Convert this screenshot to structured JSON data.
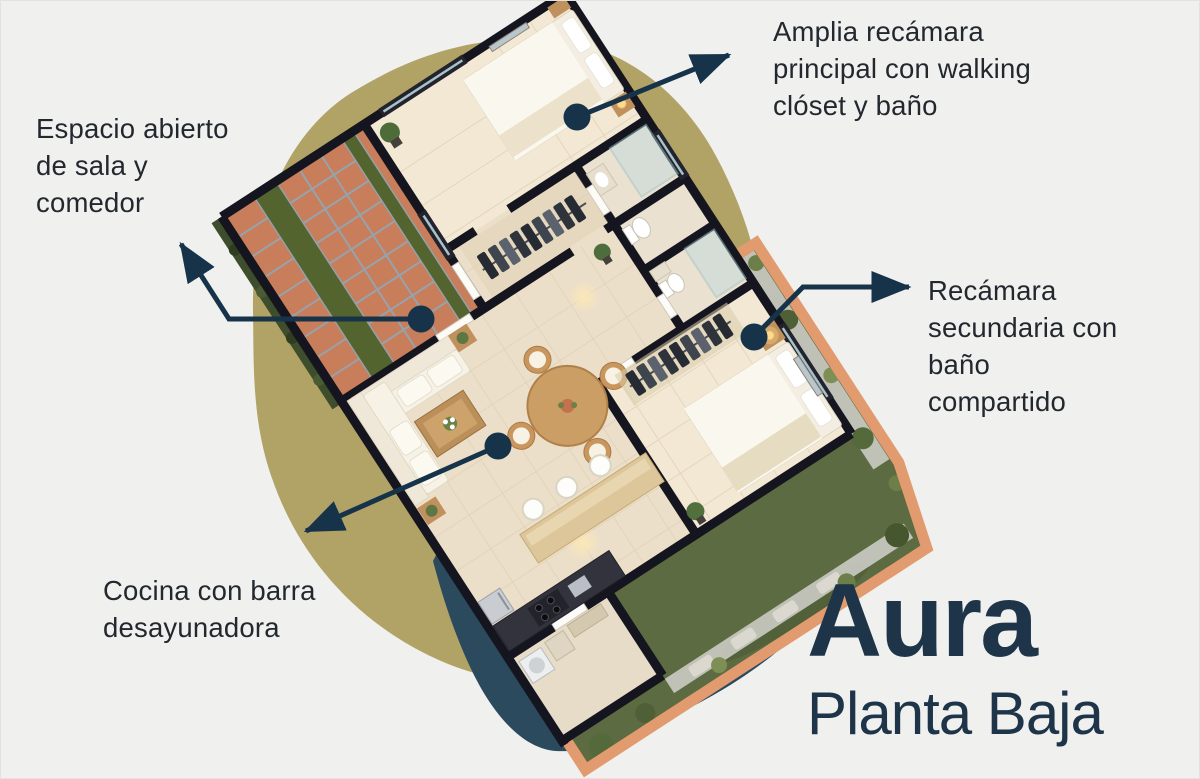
{
  "canvas": {
    "width": 1200,
    "height": 779,
    "background": "#f0f0ef"
  },
  "colors": {
    "accent_navy": "#16334a",
    "blob_olive": "#b1a266",
    "shadow_navy": "#2c4a5e",
    "title_navy": "#1e3449",
    "annotation_text": "#23282e",
    "wall_dark": "#15151f",
    "floor_cream": "#ecdfc9",
    "garden_green": "#5c6b41",
    "fence_terracotta": "#e29b6f",
    "tile_terracotta": "#c87d5b"
  },
  "annotations": {
    "master_bedroom": {
      "text": "Amplia recámara\nprincipal con walking\nclóset y baño"
    },
    "living_dining": {
      "text": "Espacio abierto\nde sala y\ncomedor"
    },
    "secondary_bedroom": {
      "text": "Recámara\nsecundaria con\nbaño\ncompartido"
    },
    "kitchen": {
      "text": "Cocina con barra\ndesayunadora"
    }
  },
  "brand": {
    "title": "Aura",
    "subtitle": "Planta Baja"
  }
}
